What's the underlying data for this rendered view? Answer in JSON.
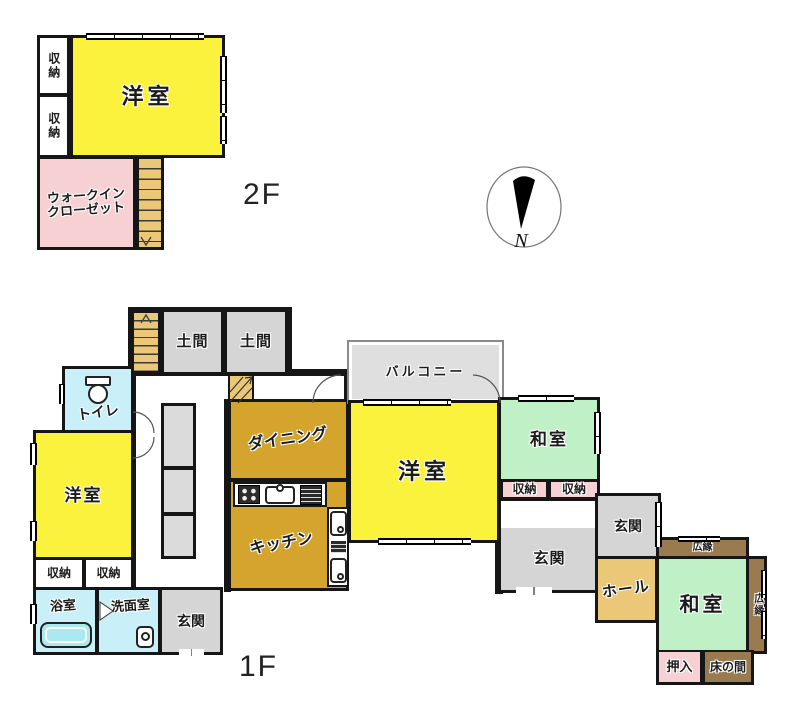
{
  "title": "間取り図",
  "compass": {
    "letter": "N"
  },
  "colors": {
    "room_yellow": "#FBF23D",
    "room_pink": "#F7D0D4",
    "room_tan": "#EBC778",
    "room_mustard": "#D5A42C",
    "room_gray": "#D5D5D5",
    "room_cyan": "#C9F0F8",
    "room_green": "#BFF0C6",
    "room_brown": "#9A7B50",
    "balcony_gray": "#DFDFDF",
    "wall_black": "#161616"
  },
  "floor2": {
    "label": "2F",
    "rooms": {
      "youshitsu": "洋室",
      "shunou_top": "収納",
      "shunou_bottom": "収納",
      "wic_line1": "ウォークイン",
      "wic_line2": "クローゼット"
    }
  },
  "floor1": {
    "label": "1F",
    "rooms": {
      "doma1": "土間",
      "doma2": "土間",
      "toilet": "トイレ",
      "youshitsu_left": "洋室",
      "shunou_left_a": "収納",
      "shunou_left_b": "収納",
      "bath": "浴室",
      "senmen": "洗面室",
      "genkan_sw": "玄関",
      "dining": "ダイニング",
      "kitchen": "キッチン",
      "balcony": "バルコニー",
      "youshitsu_center": "洋室",
      "washitsu_ne": "和室",
      "shunou_ne_a": "収納",
      "shunou_ne_b": "収納",
      "genkan_main": "玄関",
      "genkan_east": "玄関",
      "hall": "ホール",
      "hiroen_top": "広縁",
      "hiroen_right": "広縁",
      "washitsu_se": "和室",
      "oshiire": "押入",
      "tokonoma": "床の間"
    }
  }
}
